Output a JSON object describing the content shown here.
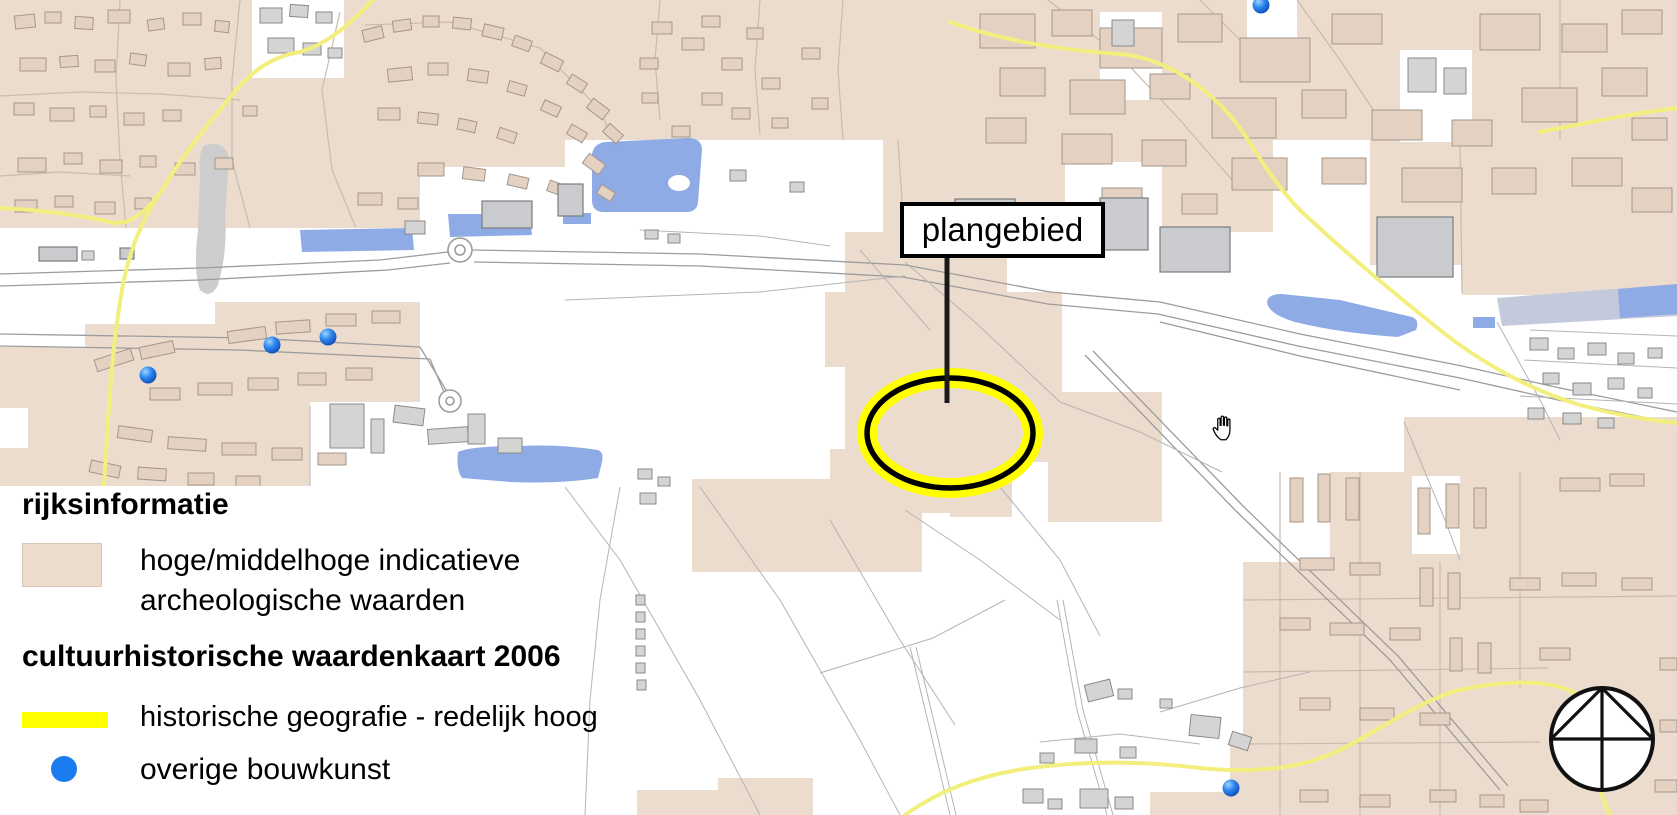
{
  "map": {
    "plangebied_label": "plangebied"
  },
  "legend": {
    "section1_title": "rijksinformatie",
    "item1_label_line1": "hoge/middelhoge indicatieve",
    "item1_label_line2": "archeologische waarden",
    "section2_title": "cultuurhistorische waardenkaart 2006",
    "item2_label": "historische geografie - redelijk hoog",
    "item3_label": "overige bouwkunst"
  },
  "colors": {
    "archaeology_beige": "#ECDCCE",
    "historic_geography_yellow": "#FFFF00",
    "bouwkunst_blue": "#1B7CF0",
    "water_blue": "#8FABE5",
    "road_yellow": "#F2EF7E"
  }
}
